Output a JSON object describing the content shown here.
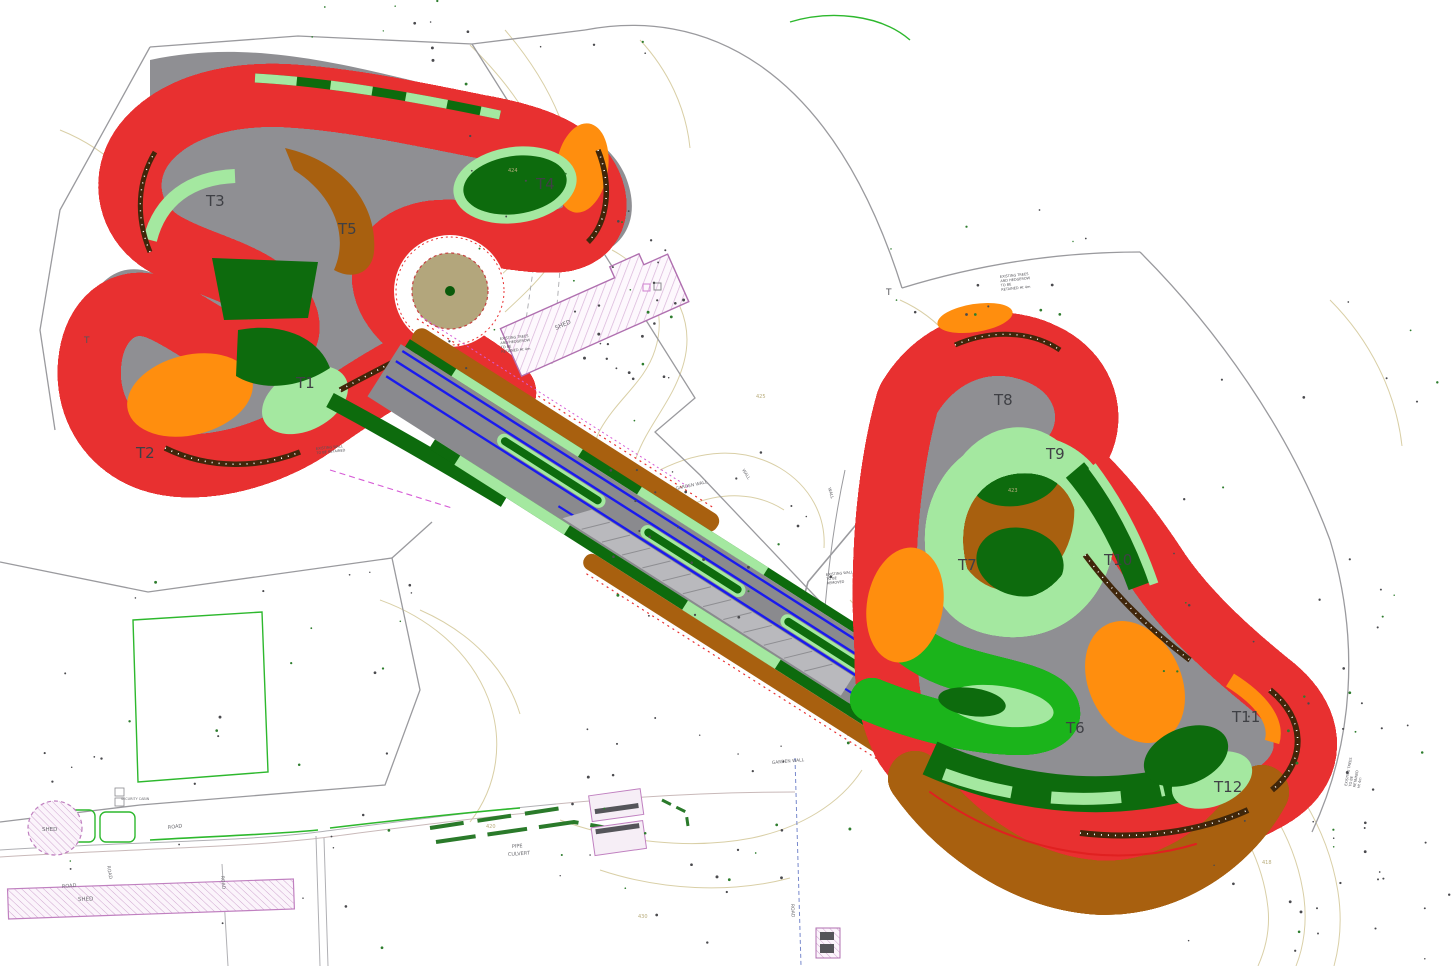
{
  "drawing": {
    "type": "race-circuit-site-plan",
    "background": "#ffffff"
  },
  "colors": {
    "track_gray": "#8a8a8e",
    "track_edge_gray": "#5d5e62",
    "apron_gray": "#b9b9bd",
    "verge_brown": "#a8600f",
    "barrier_dark": "#40260a",
    "runoff_light_green": "#a4e8a0",
    "runoff_dark_green": "#0d6b0d",
    "line_bright_green": "#1bb41b",
    "gravel_orange": "#ff8e0e",
    "edge_blue": "#1a1aee",
    "boundary_red": "#e83030",
    "boundary_magenta": "#d65bd6",
    "contour_tan": "#d6cba2",
    "field_green": "#2db82d",
    "infield_tan": "#b3a67c"
  },
  "labels": {
    "turns": [
      {
        "id": "T1",
        "x": 296,
        "y": 388
      },
      {
        "id": "T2",
        "x": 136,
        "y": 458
      },
      {
        "id": "T3",
        "x": 206,
        "y": 206
      },
      {
        "id": "T4",
        "x": 536,
        "y": 189
      },
      {
        "id": "T5",
        "x": 338,
        "y": 234
      },
      {
        "id": "T6",
        "x": 1066,
        "y": 733
      },
      {
        "id": "T7",
        "x": 958,
        "y": 570
      },
      {
        "id": "T8",
        "x": 994,
        "y": 405
      },
      {
        "id": "T9",
        "x": 1046,
        "y": 459
      },
      {
        "id": "T10",
        "x": 1104,
        "y": 565
      },
      {
        "id": "T11",
        "x": 1232,
        "y": 722
      },
      {
        "id": "T12",
        "x": 1214,
        "y": 792
      }
    ],
    "tree_marks": [
      {
        "text": "T",
        "x": 84,
        "y": 343
      },
      {
        "text": "T",
        "x": 886,
        "y": 295
      }
    ]
  },
  "annotations": [
    {
      "name": "shed-main-label",
      "text": "SHED",
      "x": 556,
      "y": 330,
      "rot": -24,
      "size": 6,
      "color": "#9a6a9a"
    },
    {
      "name": "shed-circle-label",
      "text": "SHED",
      "x": 42,
      "y": 831,
      "rot": 0,
      "size": 5.5,
      "color": "#8a8a8e"
    },
    {
      "name": "shed-rect-label",
      "text": "SHED",
      "x": 78,
      "y": 901,
      "rot": -2,
      "size": 5.5,
      "color": "#8a8a8e"
    },
    {
      "name": "road-label-1",
      "text": "ROAD",
      "x": 62,
      "y": 888,
      "rot": -5,
      "size": 5,
      "color": "#8a8a8e"
    },
    {
      "name": "road-label-2",
      "text": "ROAD",
      "x": 168,
      "y": 829,
      "rot": -7,
      "size": 5,
      "color": "#8a8a8e"
    },
    {
      "name": "road-label-3",
      "text": "ROAD",
      "x": 107,
      "y": 866,
      "rot": 80,
      "size": 4.6,
      "color": "#8a8a8e"
    },
    {
      "name": "road-label-4",
      "text": "ROAD",
      "x": 221,
      "y": 876,
      "rot": 84,
      "size": 4.6,
      "color": "#8a8a8e"
    },
    {
      "name": "road-label-5",
      "text": "ROAD",
      "x": 791,
      "y": 904,
      "rot": 87,
      "size": 4.6,
      "color": "#8a8a8e"
    },
    {
      "name": "pipe-culvert-label",
      "text": "PIPE",
      "x": 512,
      "y": 848,
      "rot": -4,
      "size": 5,
      "color": "#8a8a8e"
    },
    {
      "name": "pipe-culvert-label-2",
      "text": "CULVERT",
      "x": 508,
      "y": 856,
      "rot": -4,
      "size": 5,
      "color": "#8a8a8e"
    },
    {
      "name": "garden-wall-label-1",
      "text": "GARDEN WALL",
      "x": 676,
      "y": 490,
      "rot": -12,
      "size": 4.4,
      "color": "#9a9a80"
    },
    {
      "name": "garden-wall-label-2",
      "text": "GARDEN WALL",
      "x": 772,
      "y": 764,
      "rot": -5,
      "size": 4.4,
      "color": "#8a8a8e"
    },
    {
      "name": "wall-label-1",
      "text": "WALL",
      "x": 742,
      "y": 470,
      "rot": 58,
      "size": 4.2,
      "color": "#9a9a80"
    },
    {
      "name": "wall-label-2",
      "text": "WALL",
      "x": 828,
      "y": 488,
      "rot": 74,
      "size": 4.2,
      "color": "#9a9a80"
    },
    {
      "name": "security-cabin-label",
      "text": "SECURITY CABIN",
      "x": 121,
      "y": 800,
      "rot": 0,
      "size": 3.4,
      "color": "#6b6b70"
    }
  ],
  "notes": [
    {
      "name": "survey-note-1",
      "x": 500,
      "y": 340,
      "rot": -6,
      "size": 3.5,
      "lines": [
        "EXISTING TREES",
        "AND HEDGEROW",
        "TO BE",
        "RETAINED  Ht 4m"
      ]
    },
    {
      "name": "survey-note-2",
      "x": 316,
      "y": 450,
      "rot": -6,
      "size": 3.5,
      "lines": [
        "EXISTING WALL",
        "TO BE RETAINED"
      ]
    },
    {
      "name": "survey-note-3",
      "x": 1000,
      "y": 278,
      "rot": -6,
      "size": 3.5,
      "lines": [
        "EXISTING TREES",
        "AND HEDGEROW",
        "TO BE",
        "RETAINED  Ht 4m"
      ]
    },
    {
      "name": "survey-note-4",
      "x": 1347,
      "y": 786,
      "rot": -80,
      "size": 3.5,
      "lines": [
        "EXISTING TREES",
        "TO BE",
        "RETAINED",
        "Ht 4m"
      ]
    },
    {
      "name": "survey-note-5",
      "x": 826,
      "y": 576,
      "rot": -6,
      "size": 3.5,
      "lines": [
        "EXISTING WALL",
        "TO BE",
        "REMOVED"
      ]
    }
  ],
  "contour_labels": [
    {
      "text": "420",
      "x": 486,
      "y": 828
    },
    {
      "text": "424",
      "x": 508,
      "y": 172
    },
    {
      "text": "425",
      "x": 756,
      "y": 398
    },
    {
      "text": "423",
      "x": 1008,
      "y": 492
    },
    {
      "text": "430",
      "x": 638,
      "y": 918
    },
    {
      "text": "418",
      "x": 1262,
      "y": 864
    }
  ]
}
